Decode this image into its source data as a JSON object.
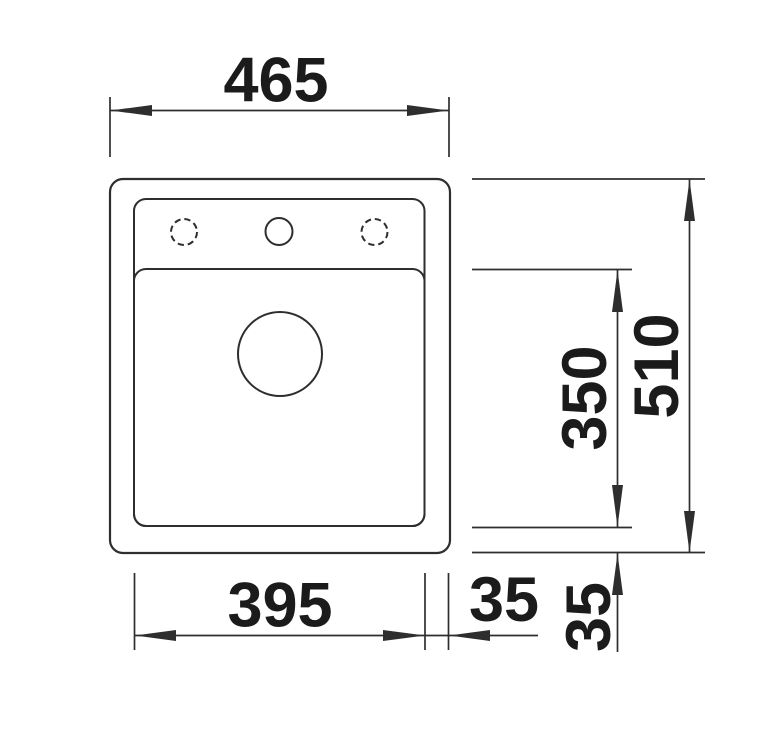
{
  "drawing": {
    "description": "sink-top-view-dimension-drawing",
    "dimensions": {
      "overall_width": "465",
      "overall_depth": "510",
      "bowl_width": "395",
      "bowl_depth": "350",
      "rim_right": "35",
      "rim_bottom": "35"
    },
    "features": {
      "tap_holes": {
        "count": 3,
        "center_style": "solid",
        "outer_style": "dashed"
      },
      "drain": {
        "shape": "circle"
      }
    },
    "colors": {
      "line": "#2e2e2e",
      "text": "#1b1b1b",
      "background": "#ffffff"
    }
  }
}
